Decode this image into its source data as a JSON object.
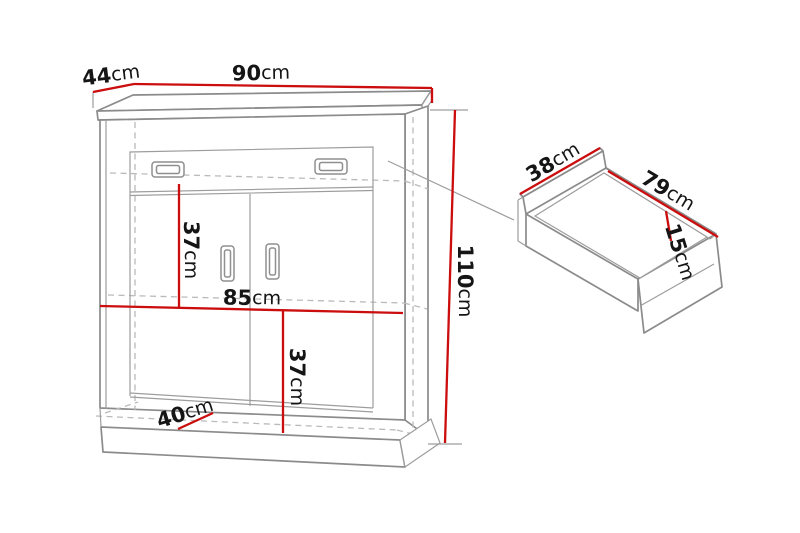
{
  "figure": {
    "type": "furniture-dimension-diagram",
    "background": "#ffffff",
    "colors": {
      "dimension_line_red": "#cb0d0d",
      "outline_gray": "#8b8b8b",
      "hidden_line_gray": "#bababa",
      "label_black": "#151515"
    },
    "cabinet": {
      "description": "two-door cabinet with one top drawer on plinth base",
      "dims": {
        "depth": {
          "value": "44",
          "unit": "cm"
        },
        "width": {
          "value": "90",
          "unit": "cm"
        },
        "height": {
          "value": "110",
          "unit": "cm"
        },
        "upper_section": {
          "value": "37",
          "unit": "cm"
        },
        "inner_width": {
          "value": "85",
          "unit": "cm"
        },
        "lower_section": {
          "value": "37",
          "unit": "cm"
        },
        "base_depth": {
          "value": "40",
          "unit": "cm"
        }
      }
    },
    "drawer": {
      "description": "pulled-out drawer detail view",
      "dims": {
        "depth": {
          "value": "38",
          "unit": "cm"
        },
        "width": {
          "value": "79",
          "unit": "cm"
        },
        "height": {
          "value": "15",
          "unit": "cm"
        }
      }
    }
  }
}
